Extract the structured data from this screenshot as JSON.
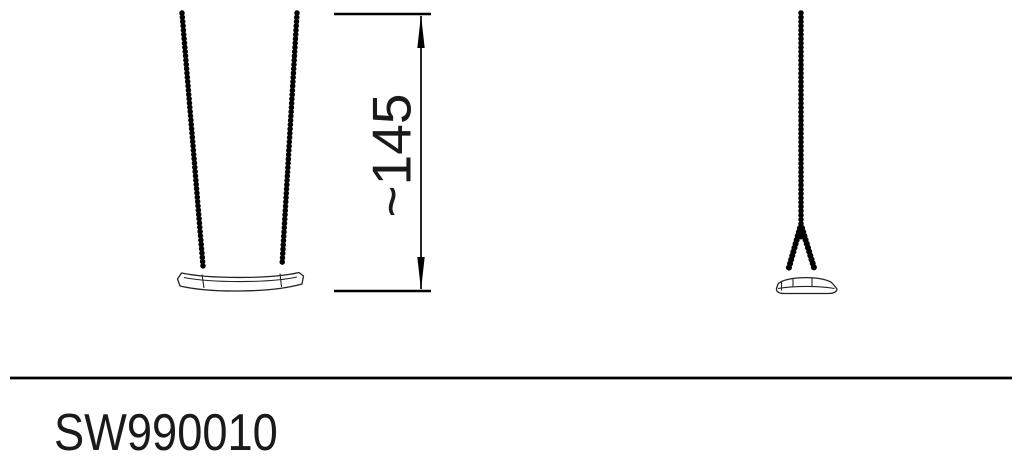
{
  "colors": {
    "background": "#ffffff",
    "line": "#000000",
    "text": "#1a1a1a"
  },
  "drawing": {
    "front_view": "swing seat front view with two chains",
    "side_view": "swing seat side view with single chain",
    "dimension": {
      "label": "~145"
    }
  },
  "footer": {
    "product_code": "SW990010"
  }
}
